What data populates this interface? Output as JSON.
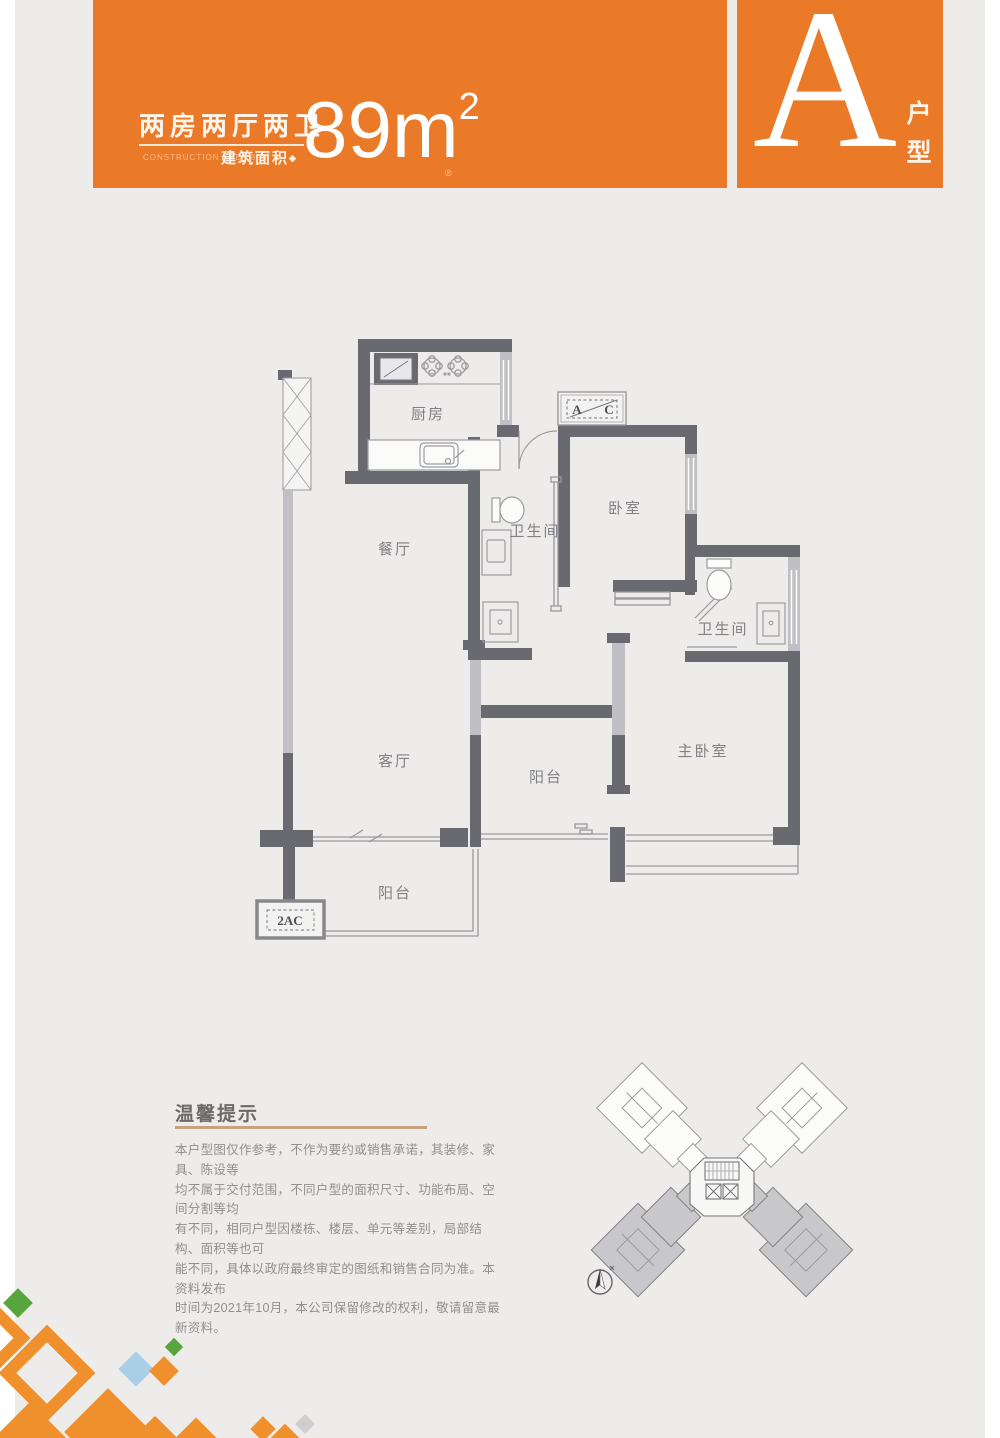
{
  "banner": {
    "title": "两房两厅两卫",
    "subtitle_en": "CONSTRUCTION AREA 89㎡",
    "area_label": "建筑面积",
    "area_marker": "◆",
    "area_value": "89m",
    "area_sup": "2",
    "reg_mark": "®",
    "unit_letter": "A",
    "unit_type": "户型"
  },
  "plan": {
    "rooms": {
      "kitchen": "厨房",
      "dining": "餐厅",
      "bath1": "卫生间",
      "bedroom": "卧室",
      "bath2": "卫生间",
      "master": "主卧室",
      "living": "客厅",
      "balcony_side": "阳台",
      "balcony_rear": "阳台"
    },
    "markers": {
      "ac_a": "A",
      "ac_c": "C",
      "ac_platform": "2AC"
    }
  },
  "tips": {
    "title": "温馨提示",
    "lines": [
      "本户型图仅作参考，不作为要约或销售承诺，其装修、家具、陈设等",
      "均不属于交付范围，不同户型的面积尺寸、功能布局、空间分割等均",
      "有不同，相同户型因楼栋、楼层、单元等差别，局部结构、面积等也可",
      "能不同，具体以政府最终审定的图纸和销售合同为准。本资料发布",
      "时间为2021年10月，本公司保留修改的权利，敬请留意最新资料。"
    ]
  },
  "colors": {
    "accent": "#EA7A27",
    "decor_orange": "#F0902C",
    "decor_green": "#57A53C",
    "decor_blue": "#A9CFE7",
    "tips_rule": "#C8A27E",
    "wall_dark": "#696970",
    "wall_light": "#C0C0C4"
  }
}
